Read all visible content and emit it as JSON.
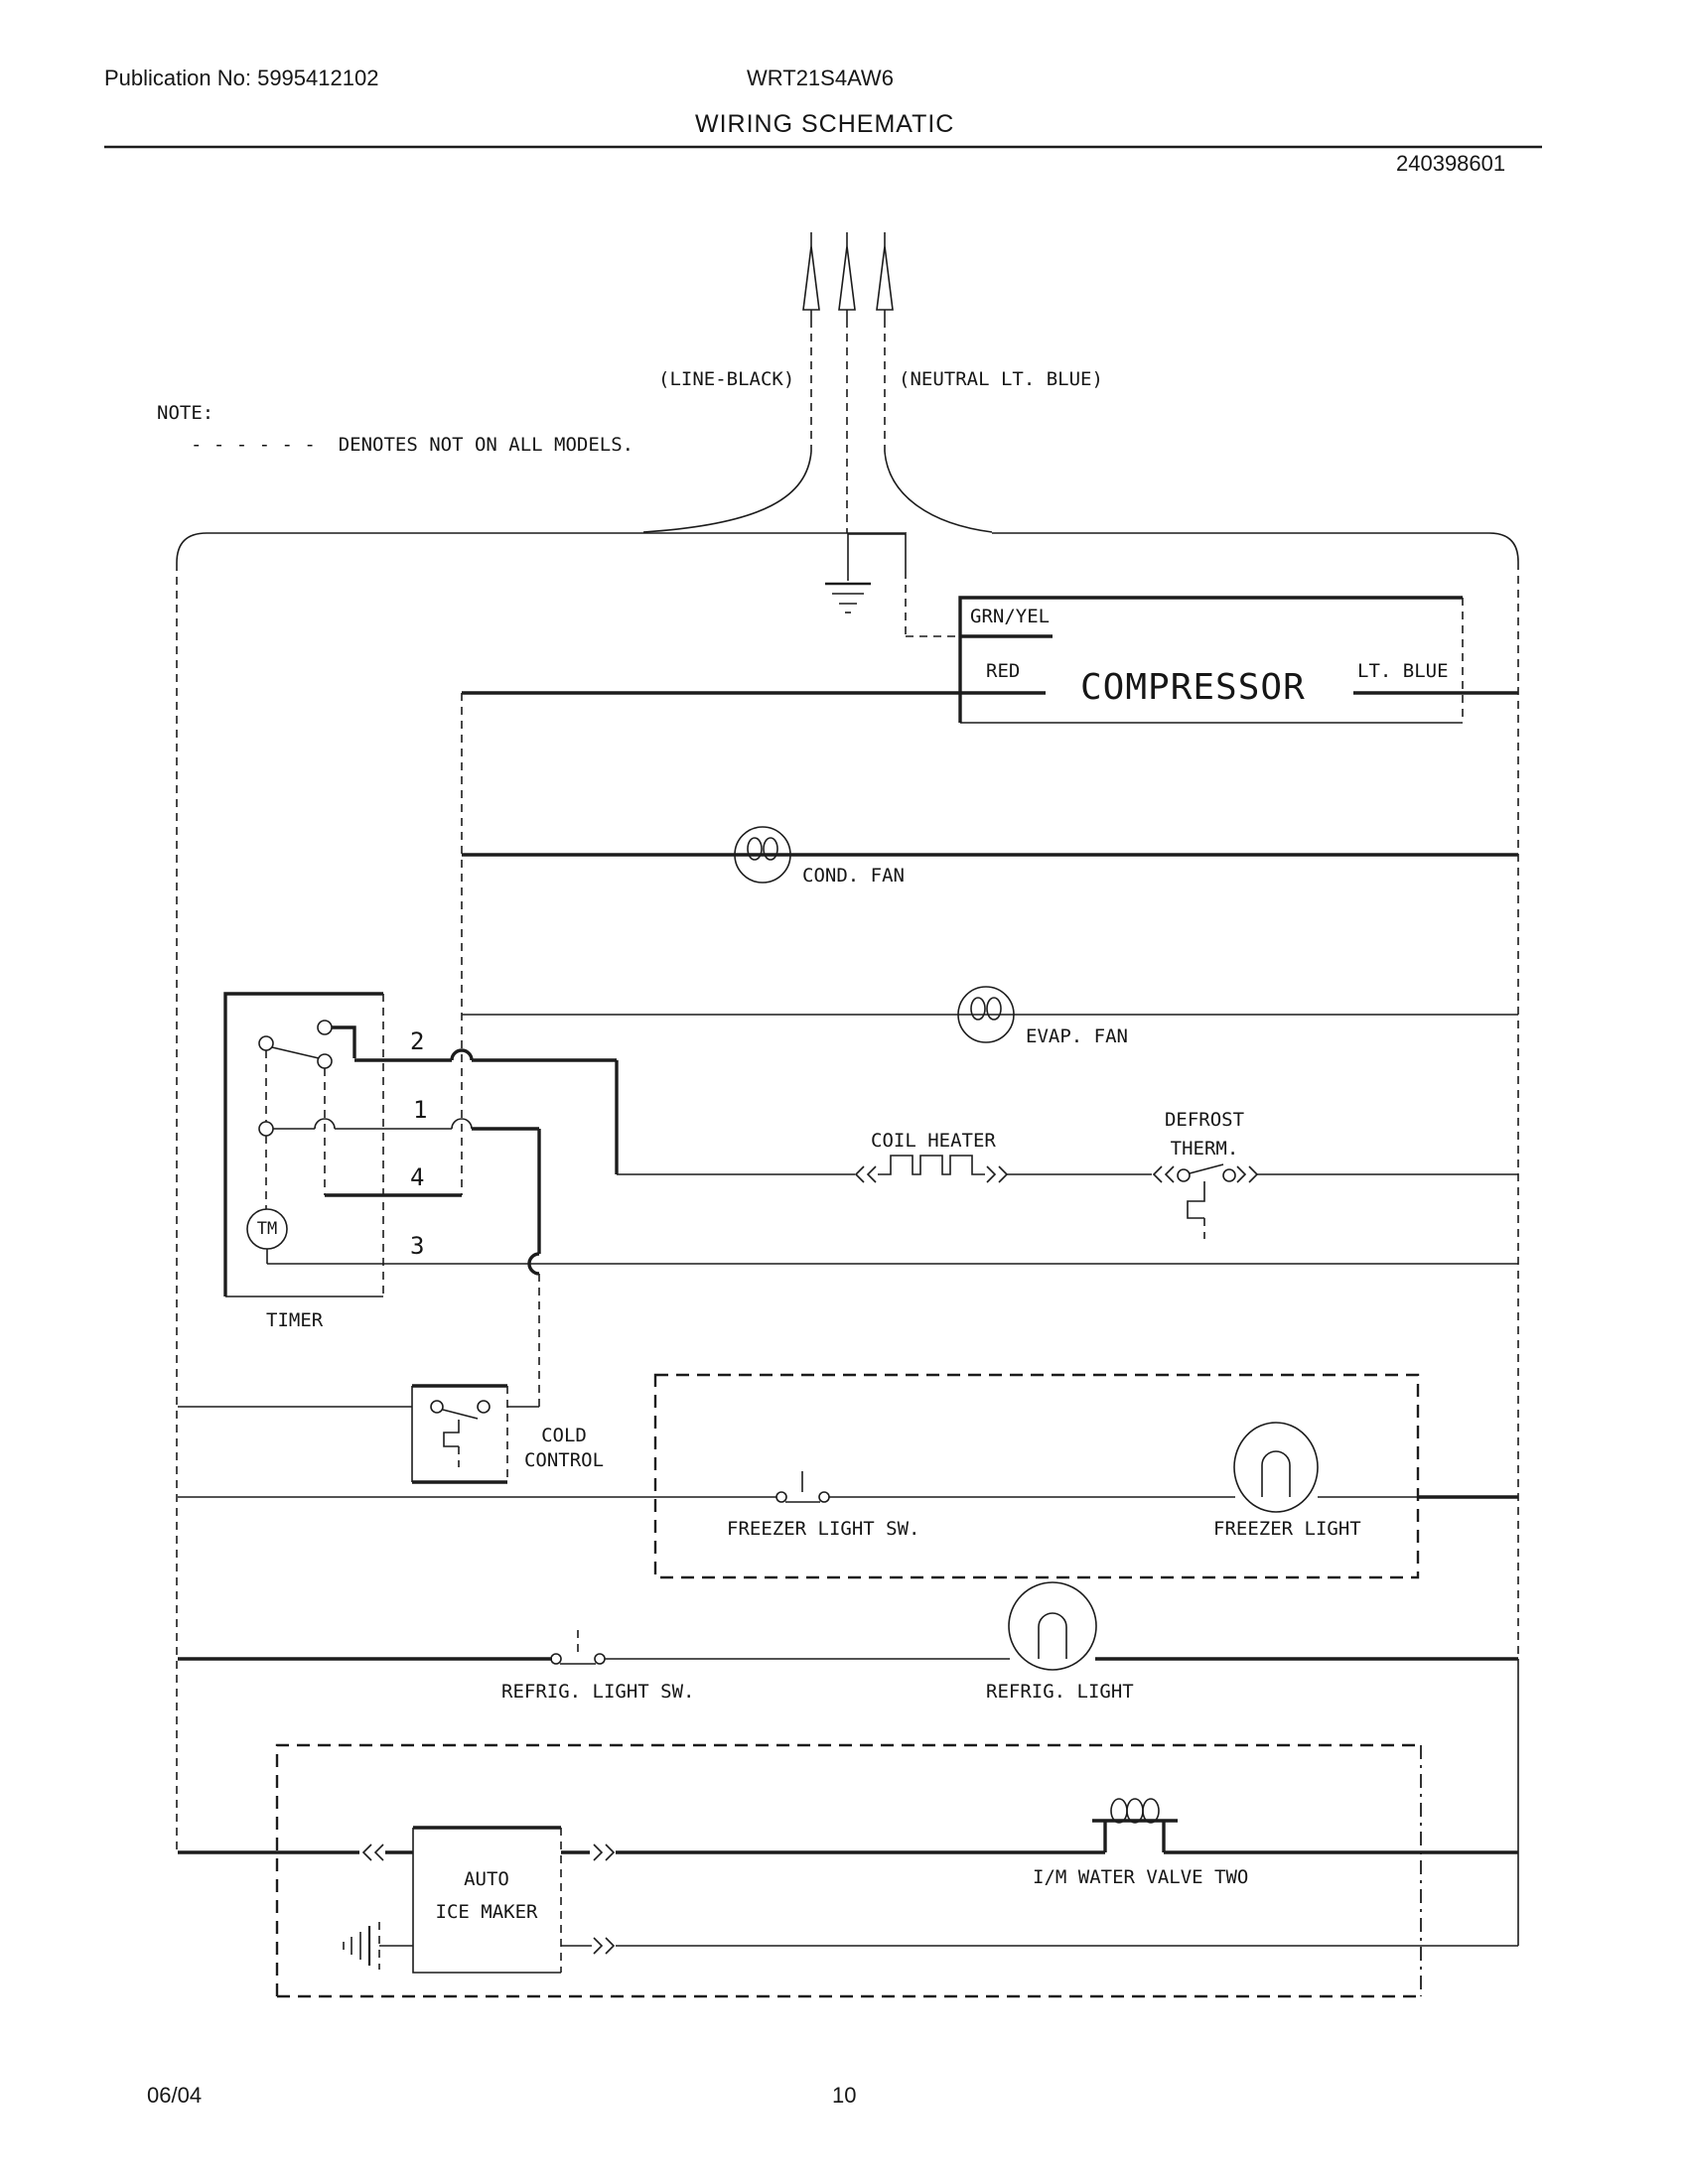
{
  "header": {
    "publication": "Publication No: 5995412102",
    "model": "WRT21S4AW6",
    "title": "WIRING SCHEMATIC",
    "part_number": "240398601"
  },
  "note": {
    "label": "NOTE:",
    "text": "- - - - - -  DENOTES NOT ON ALL MODELS."
  },
  "supply": {
    "line_label": "(LINE-BLACK)",
    "neutral_label": "(NEUTRAL LT. BLUE)"
  },
  "compressor": {
    "name": "COMPRESSOR",
    "wire_grn_yel": "GRN/YEL",
    "wire_red": "RED",
    "wire_lt_blue": "LT. BLUE"
  },
  "components": {
    "cond_fan": "COND. FAN",
    "evap_fan": "EVAP. FAN",
    "coil_heater": "COIL HEATER",
    "defrost_therm_line1": "DEFROST",
    "defrost_therm_line2": "THERM.",
    "cold_control_line1": "COLD",
    "cold_control_line2": "CONTROL",
    "freezer_light_sw": "FREEZER LIGHT SW.",
    "freezer_light": "FREEZER LIGHT",
    "refrig_light_sw": "REFRIG. LIGHT SW.",
    "refrig_light": "REFRIG. LIGHT",
    "auto_ice_maker_line1": "AUTO",
    "auto_ice_maker_line2": "ICE MAKER",
    "im_water_valve": "I/M WATER VALVE TWO"
  },
  "timer": {
    "label": "TIMER",
    "motor": "TM",
    "terminals": [
      "2",
      "1",
      "4",
      "3"
    ]
  },
  "footer": {
    "date": "06/04",
    "page": "10"
  },
  "colors": {
    "ink": "#1c1c1c",
    "paper": "#ffffff"
  }
}
